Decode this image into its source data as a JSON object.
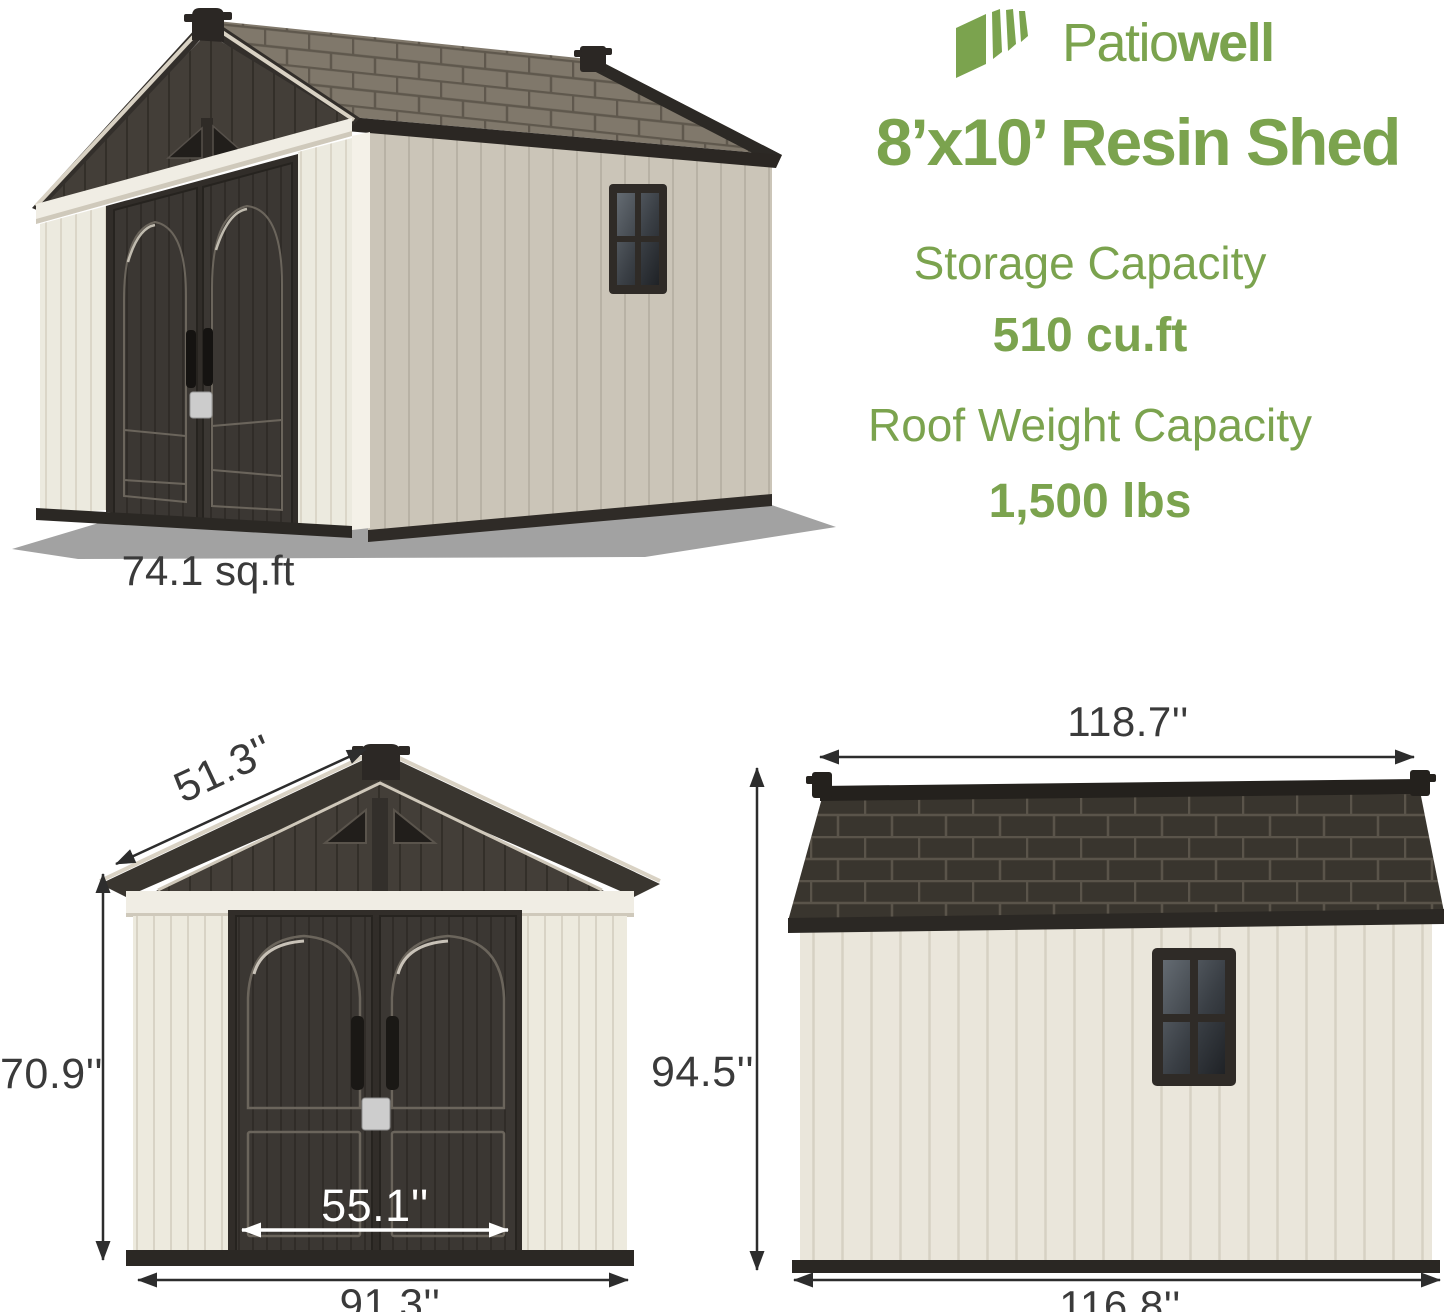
{
  "brand": {
    "name_regular": "Patio",
    "name_bold": "well"
  },
  "header": {
    "title": "8’x10’ Resin Shed"
  },
  "specs": [
    {
      "label": "Storage Capacity",
      "value": "510 cu.ft"
    },
    {
      "label": "Roof Weight Capacity",
      "value": "1,500 lbs"
    }
  ],
  "views": {
    "perspective": {
      "footprint": "74.1 sq.ft"
    },
    "front": {
      "roof_panel_length": "51.3''",
      "wall_height": "70.9''",
      "door_width": "55.1''",
      "overall_width": "91.3''"
    },
    "side": {
      "roof_length": "118.7''",
      "overall_height": "94.5''",
      "base_length": "116.8''"
    }
  },
  "colors": {
    "brand_green": "#7ba34e",
    "dimension_text": "#3a3a3a",
    "dimension_line": "#2d2d2d",
    "wall_cream": "#edeade",
    "wall_taupe": "#cbc5b8",
    "roof_dark": "#39352e",
    "door_dark": "#3b3733"
  }
}
